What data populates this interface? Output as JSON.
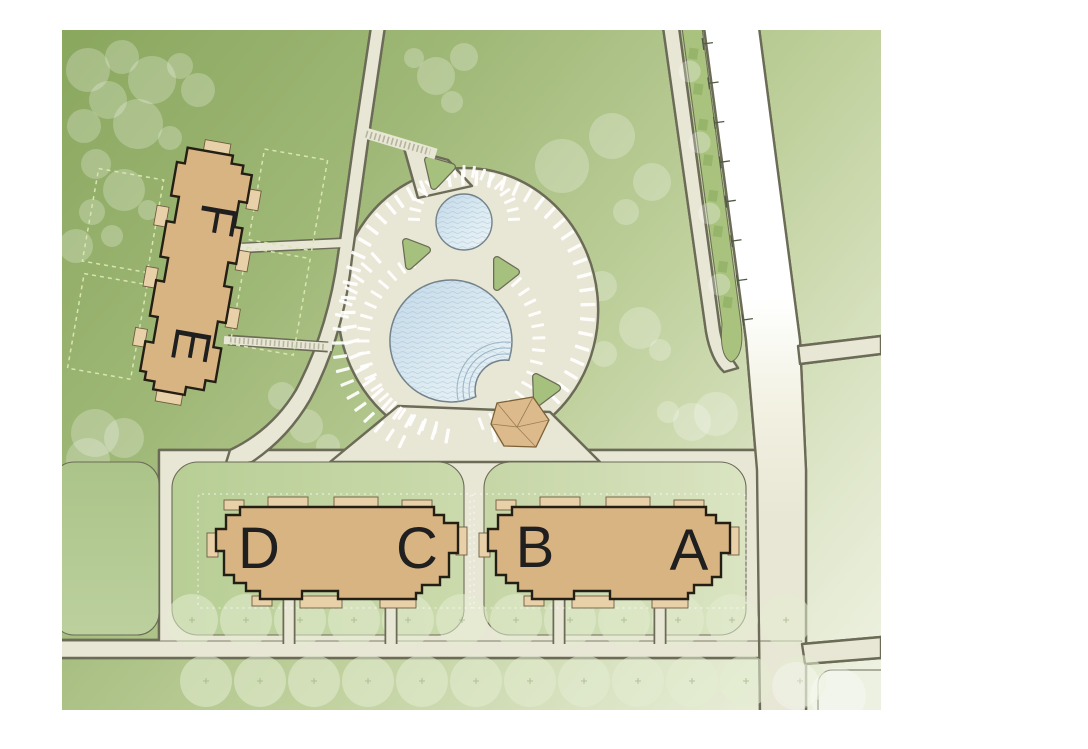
{
  "site_plan": {
    "buildings": [
      {
        "label": "A"
      },
      {
        "label": "B"
      },
      {
        "label": "C"
      },
      {
        "label": "D"
      },
      {
        "label": "E"
      },
      {
        "label": "F"
      }
    ],
    "palette": {
      "lawn_dark": "#8AA75E",
      "lawn_light": "#F0F3E5",
      "road_fill": "#E8E6D4",
      "road_edge": "#6B6B57",
      "highway_white": "#FFFFFF",
      "building_fill": "#D9B483",
      "building_trim": "#E8D0A9",
      "building_outline": "#241F15",
      "label_color": "#1F1F1F",
      "pool_water_dark": "#C3D8E8",
      "pool_water_light": "#EDF4F8",
      "pool_edge": "#72818A",
      "cabana_fill": "#DDBA8C",
      "cabana_edge": "#7C6036",
      "island_green": "#A6C17D",
      "median_green": "#A9C27E",
      "hedge_green": "#93B468",
      "stall_white": "#FFFFFF",
      "tree_canopy": "rgba(255,255,255,0.24)",
      "street_tree": "#E3ECD2",
      "patio_dash_green": "#D7E6B0",
      "patio_dash_white": "rgba(255,255,255,0.5)"
    }
  }
}
